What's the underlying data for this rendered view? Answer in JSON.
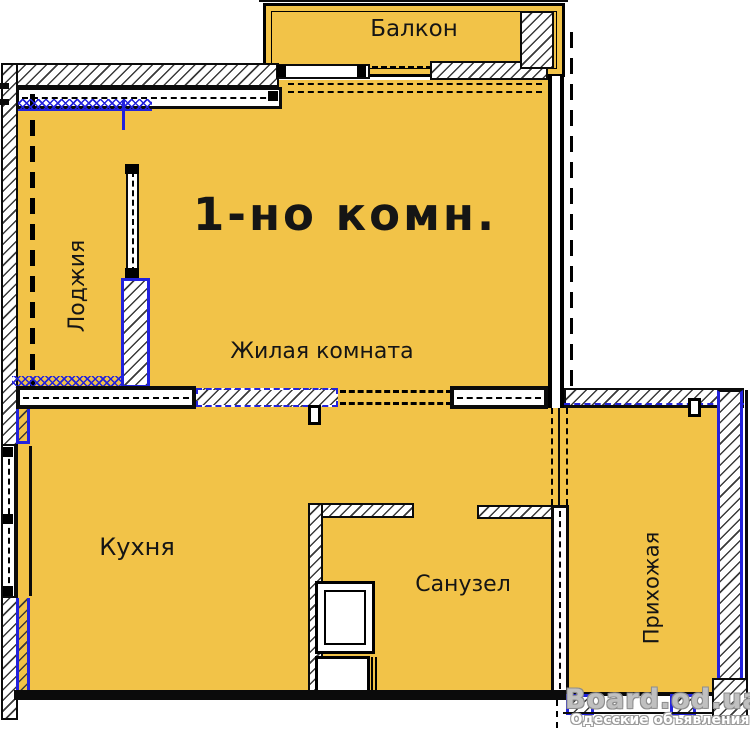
{
  "plan": {
    "title": "1-но комн.",
    "rooms": {
      "balcony": "Балкон",
      "loggia": "Лоджия",
      "living": "Жилая комната",
      "kitchen": "Кухня",
      "bathroom": "Санузел",
      "hallway": "Прихожая"
    },
    "colors": {
      "room_fill": "#F2C348",
      "wall": "#0B0B0B",
      "accent": "#2222DD",
      "background": "#FFFFFF"
    }
  },
  "watermark": {
    "site": "Board.od.ua",
    "tagline": "Одесские объявления"
  }
}
